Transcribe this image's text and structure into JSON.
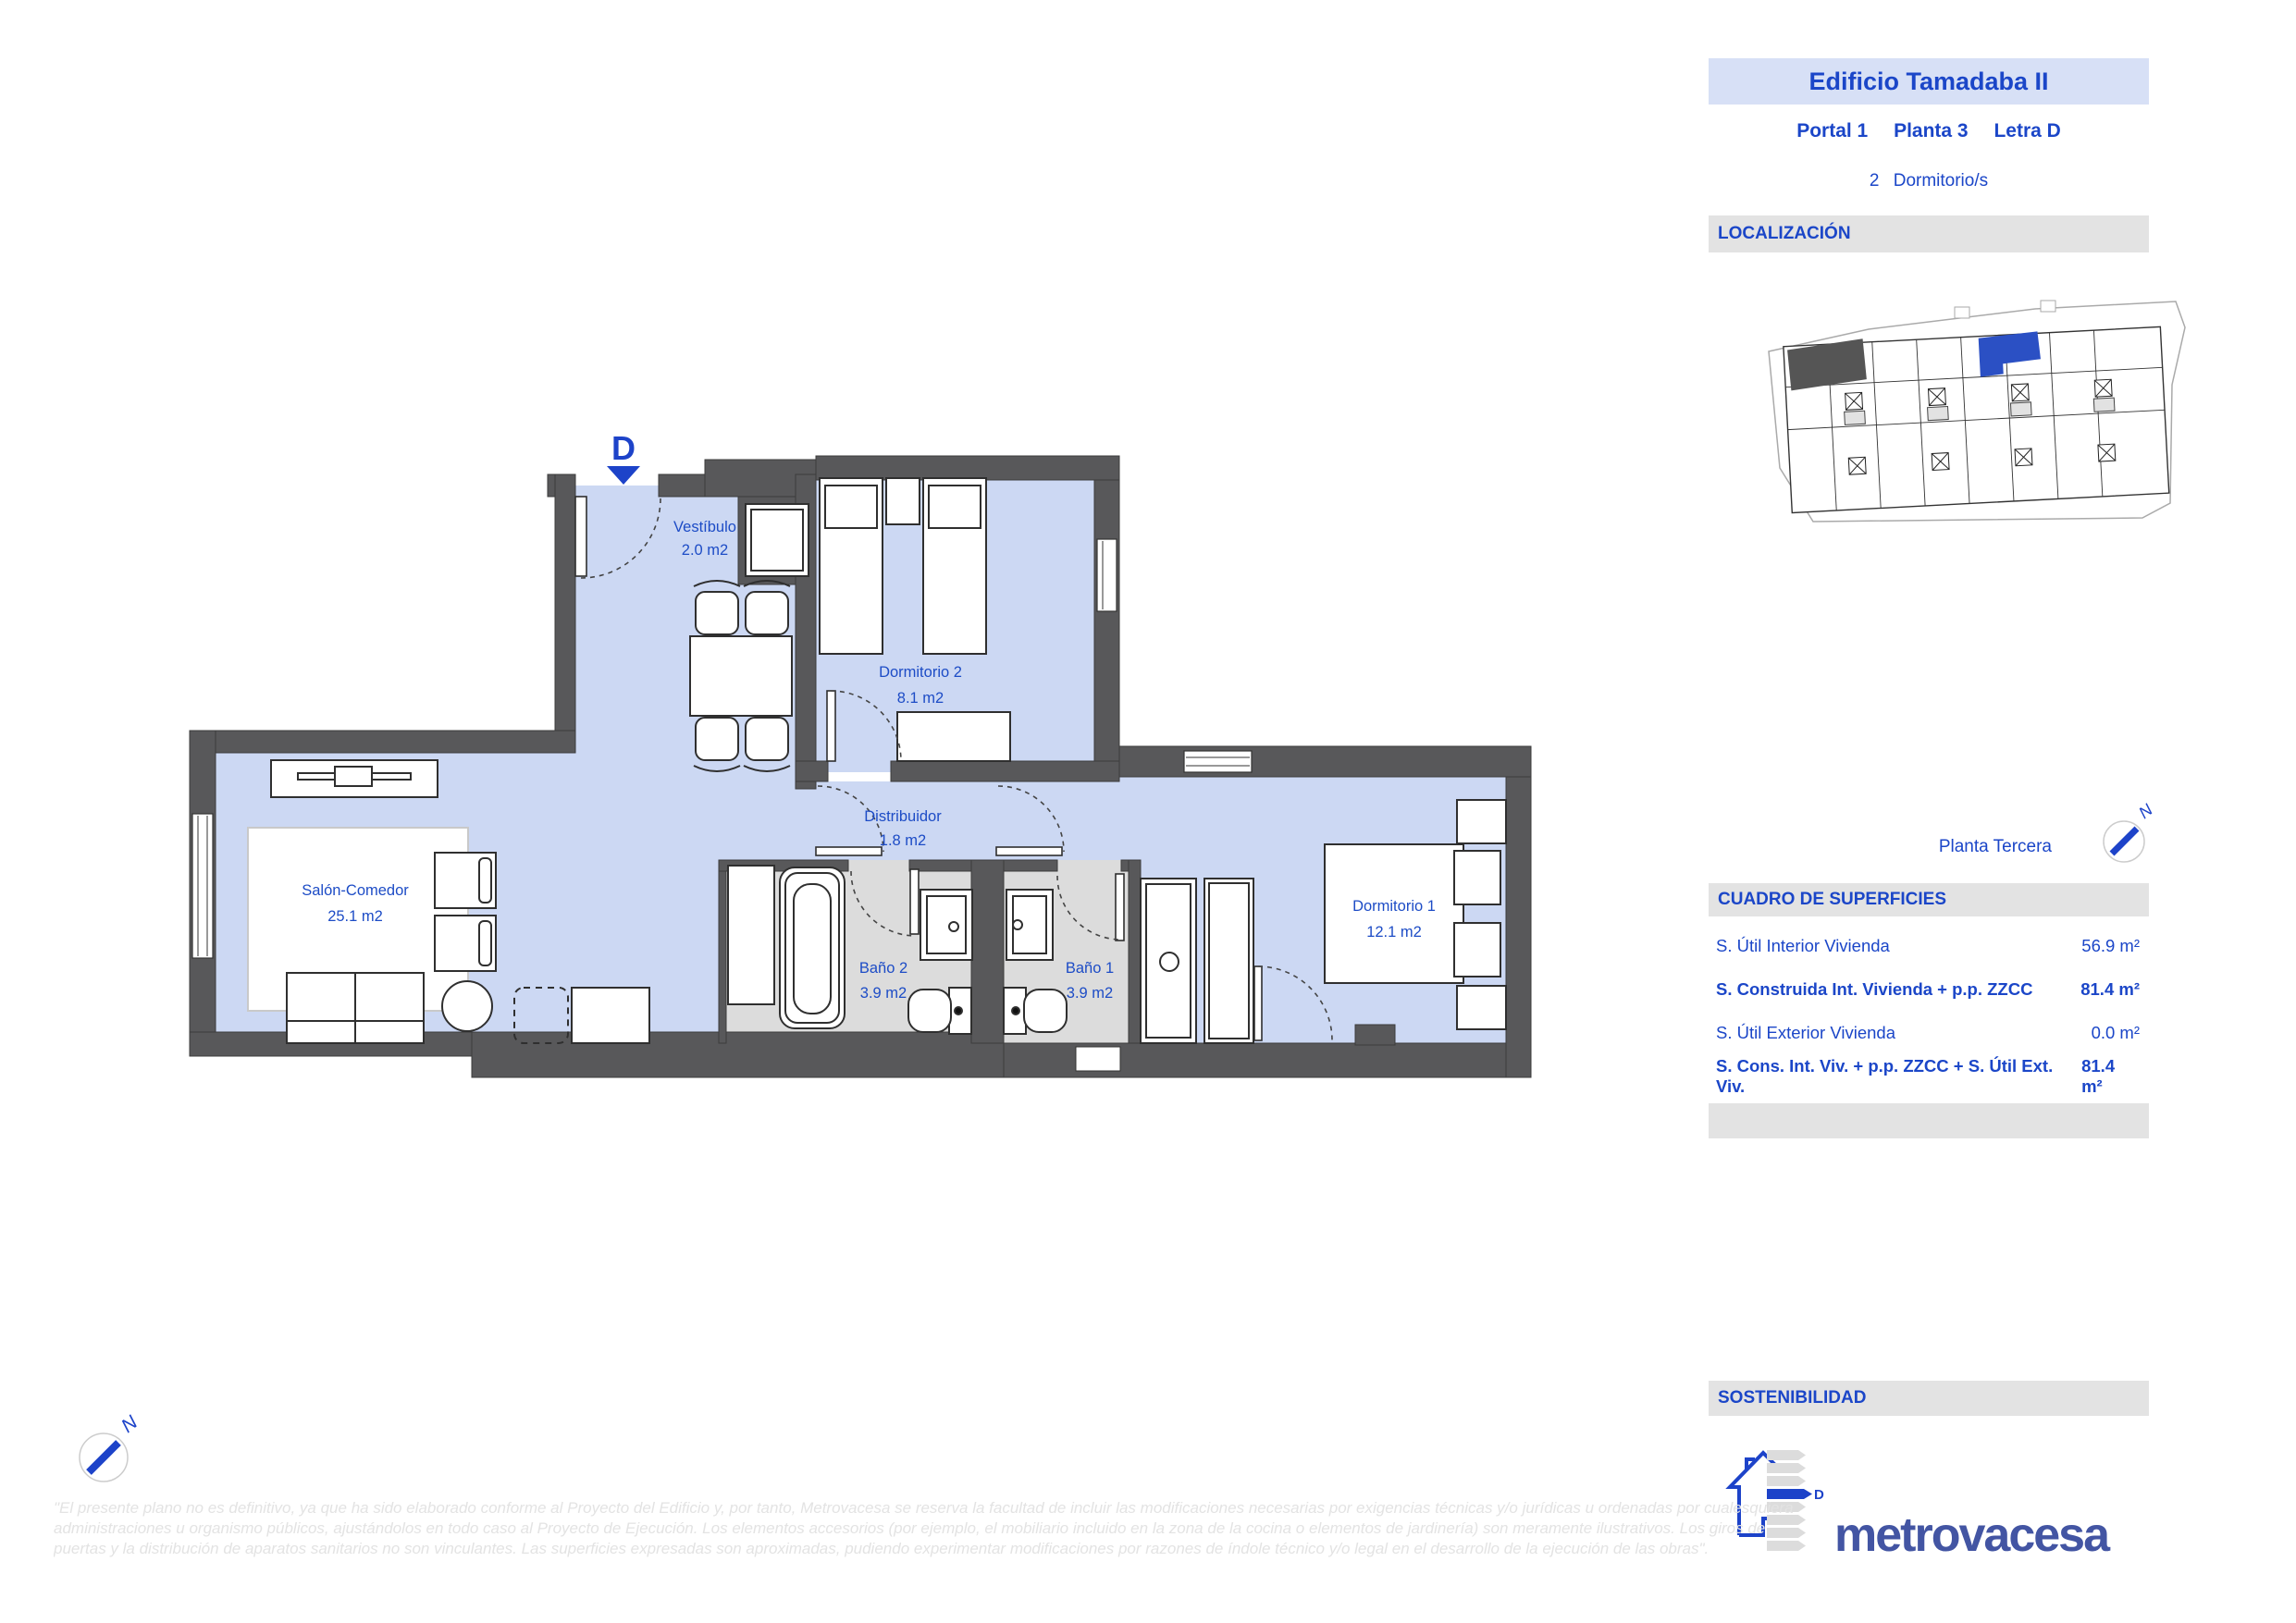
{
  "header": {
    "building": "Edificio Tamadaba II",
    "portal": "Portal 1",
    "planta": "Planta 3",
    "letra": "Letra D",
    "bedrooms_count": "2",
    "bedrooms_label": "Dormitorio/s"
  },
  "sections": {
    "localizacion": "LOCALIZACIÓN",
    "cuadro": "CUADRO DE SUPERFICIES",
    "sostenibilidad": "SOSTENIBILIDAD"
  },
  "floor_name": "Planta Tercera",
  "compass": {
    "label": "N"
  },
  "unit_marker": {
    "letter": "D"
  },
  "energy": {
    "rating": "D"
  },
  "brand": {
    "logo": "metrovacesa"
  },
  "accent_colors": {
    "blue_text": "#1b46c8",
    "plan_floor": "#ccd8f3",
    "bath_floor": "#dcdcdc",
    "wall_gray": "#58585a",
    "highlight_unit_blue": "#2b50c4",
    "logo_indigo": "#4355a3"
  },
  "surfaces": {
    "rows": [
      {
        "label": "S. Útil Interior Vivienda",
        "value": "56.9 m²"
      },
      {
        "label": "S. Construida Int. Vivienda + p.p. ZZCC",
        "value": "81.4 m²"
      },
      {
        "label": "S. Útil Exterior Vivienda",
        "value": "0.0 m²"
      },
      {
        "label": "S. Cons. Int. Viv. + p.p. ZZCC + S. Útil Ext. Viv.",
        "value": "81.4 m²"
      }
    ]
  },
  "plan": {
    "rooms": [
      {
        "name": "Vestíbulo",
        "area": "2.0 m2"
      },
      {
        "name": "Dormitorio 2",
        "area": "8.1 m2"
      },
      {
        "name": "Distribuidor",
        "area": "1.8 m2"
      },
      {
        "name": "Salón-Comedor",
        "area": "25.1 m2"
      },
      {
        "name": "Baño 2",
        "area": "3.9 m2"
      },
      {
        "name": "Baño 1",
        "area": "3.9 m2"
      },
      {
        "name": "Dormitorio 1",
        "area": "12.1 m2"
      }
    ]
  },
  "disclaimer": {
    "line1": "\"El presente plano no es definitivo, ya que ha sido elaborado conforme al Proyecto del Edificio y, por tanto, Metrovacesa se reserva la facultad de incluir las modificaciones necesarias por exigencias técnicas y/o jurídicas u ordenadas por cualesquiera",
    "line2": "administraciones u organismo públicos, ajustándolos en todo caso al Proyecto de Ejecución. Los elementos accesorios (por ejemplo, el mobiliario incluido en la zona de la cocina o elementos de jardinería) son meramente ilustrativos. Los giros de",
    "line3": "puertas y la distribución de aparatos sanitarios no son vinculantes. Las superficies expresadas son aproximadas, pudiendo experimentar modificaciones por razones de índole técnico y/o legal en el desarrollo de la ejecución de las obras\"."
  }
}
